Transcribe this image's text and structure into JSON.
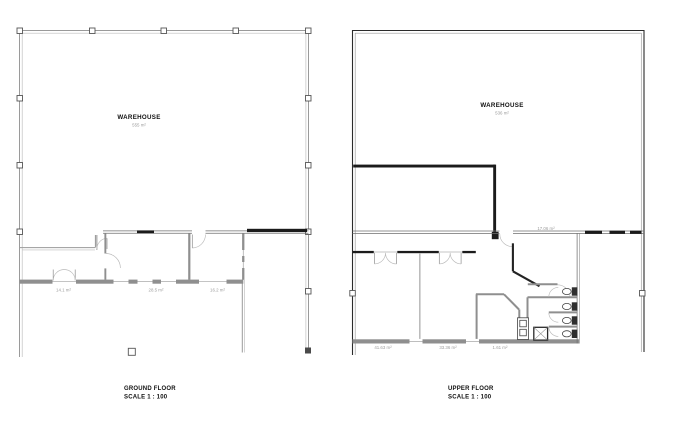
{
  "colors": {
    "background": "#ffffff",
    "wall_dark": "#1b1b1b",
    "wall_gray": "#8f8f8f",
    "wall_light": "#9a9a9a",
    "area_text": "#9c9c9c",
    "label_text": "#101010"
  },
  "ground_floor": {
    "title": "GROUND FLOOR",
    "scale": "SCALE 1 : 100",
    "warehouse": {
      "name": "WAREHOUSE",
      "area": "555 m²"
    },
    "rooms": [
      {
        "area": "14.1 m²"
      },
      {
        "area": "28.5 m²"
      },
      {
        "area": "16.2 m²"
      }
    ]
  },
  "upper_floor": {
    "title": "UPPER FLOOR",
    "scale": "SCALE 1 : 100",
    "warehouse": {
      "name": "WAREHOUSE",
      "area": "536 m²"
    },
    "rooms": [
      {
        "area": "41.63 m²"
      },
      {
        "area": "33.36 m²"
      },
      {
        "area": "1.61 m²"
      },
      {
        "area": "17.06 m²"
      }
    ]
  }
}
